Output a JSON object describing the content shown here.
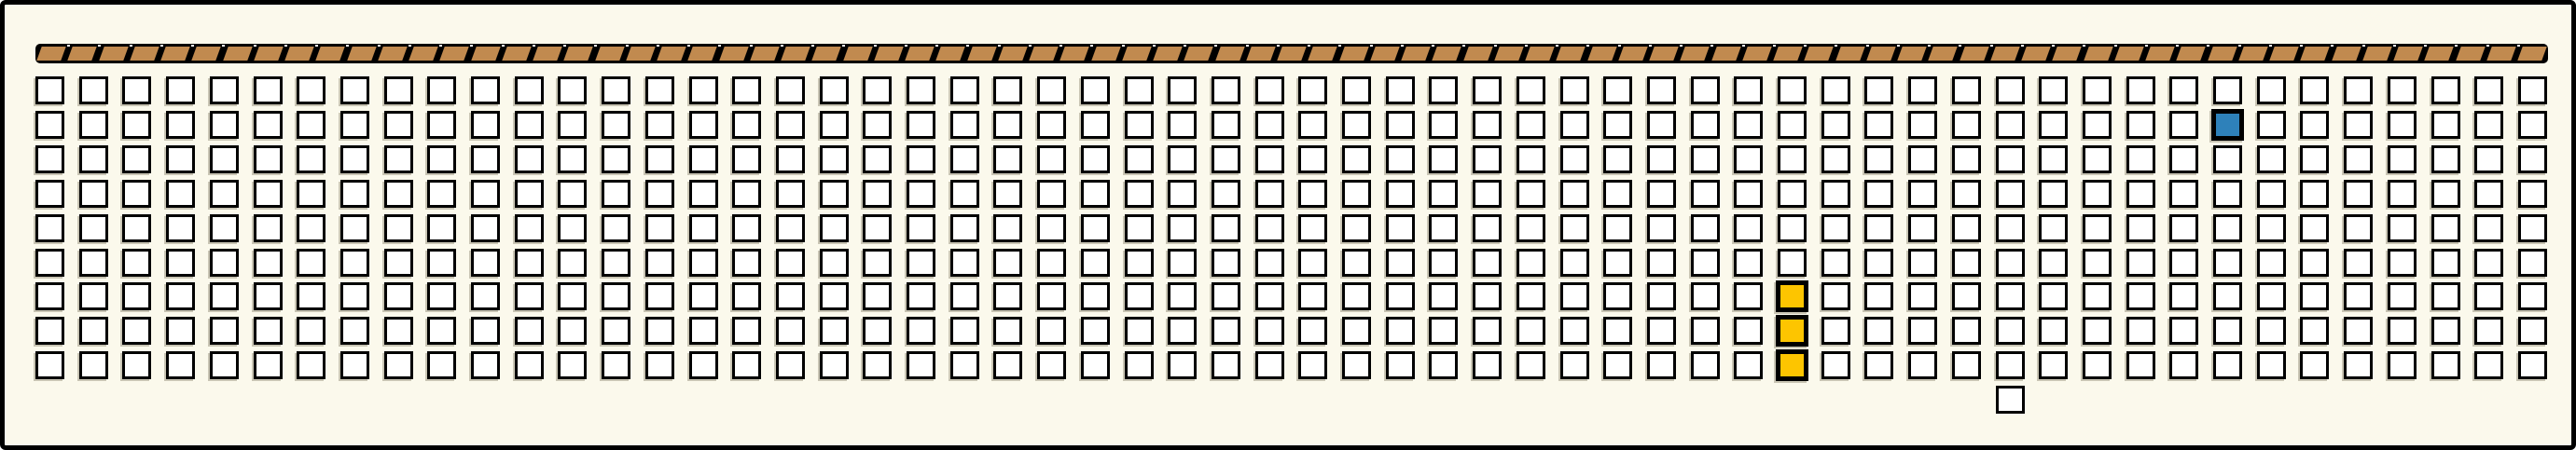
{
  "panel": {
    "background": "#fbf9ec",
    "frame_color": "#000000"
  },
  "header_strip": {
    "tile_count": 81,
    "tile_color": "#c18a4f",
    "bar_color": "#000000",
    "tick_color": "#ffffff"
  },
  "grid": {
    "rows": 9,
    "cols": 58,
    "cell_fill": "#ffffff",
    "cell_border": "#000000",
    "shadow_color": "#c9c5b4",
    "special_cells": [
      {
        "row": 1,
        "col": 50,
        "color": "#2e81ba",
        "name": "blue-highlight-cell"
      },
      {
        "row": 6,
        "col": 40,
        "color": "#fdc500",
        "name": "yellow-highlight-cell"
      },
      {
        "row": 7,
        "col": 40,
        "color": "#fdc500",
        "name": "yellow-highlight-cell"
      },
      {
        "row": 8,
        "col": 40,
        "color": "#fdc500",
        "name": "yellow-highlight-cell"
      }
    ],
    "extra_cells": [
      {
        "row": 9,
        "col": 45,
        "color": "#ffffff",
        "name": "detached-cell",
        "shadow": false
      }
    ]
  }
}
